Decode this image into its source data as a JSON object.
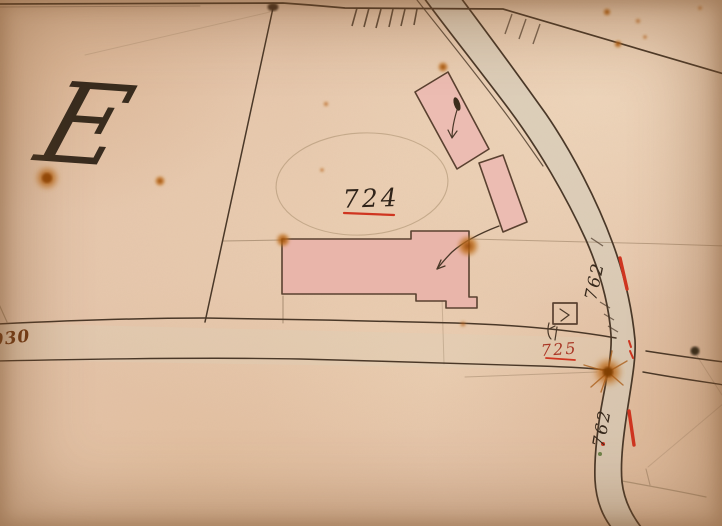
{
  "map": {
    "description": "historical hand-drawn cadastral map sheet",
    "labels": {
      "section_letter": "E",
      "road_left": "930",
      "parcel_main": "724",
      "parcel_small": "725",
      "road_upper": "762",
      "road_lower": "762"
    },
    "colors": {
      "paper": "#e5c5ab",
      "ink": "#4a3828",
      "red_ink": "#cf3520",
      "building_fill": "#e9b5aa",
      "road_fill": "#d4ccba",
      "rust_stain": "#b05a10"
    }
  }
}
